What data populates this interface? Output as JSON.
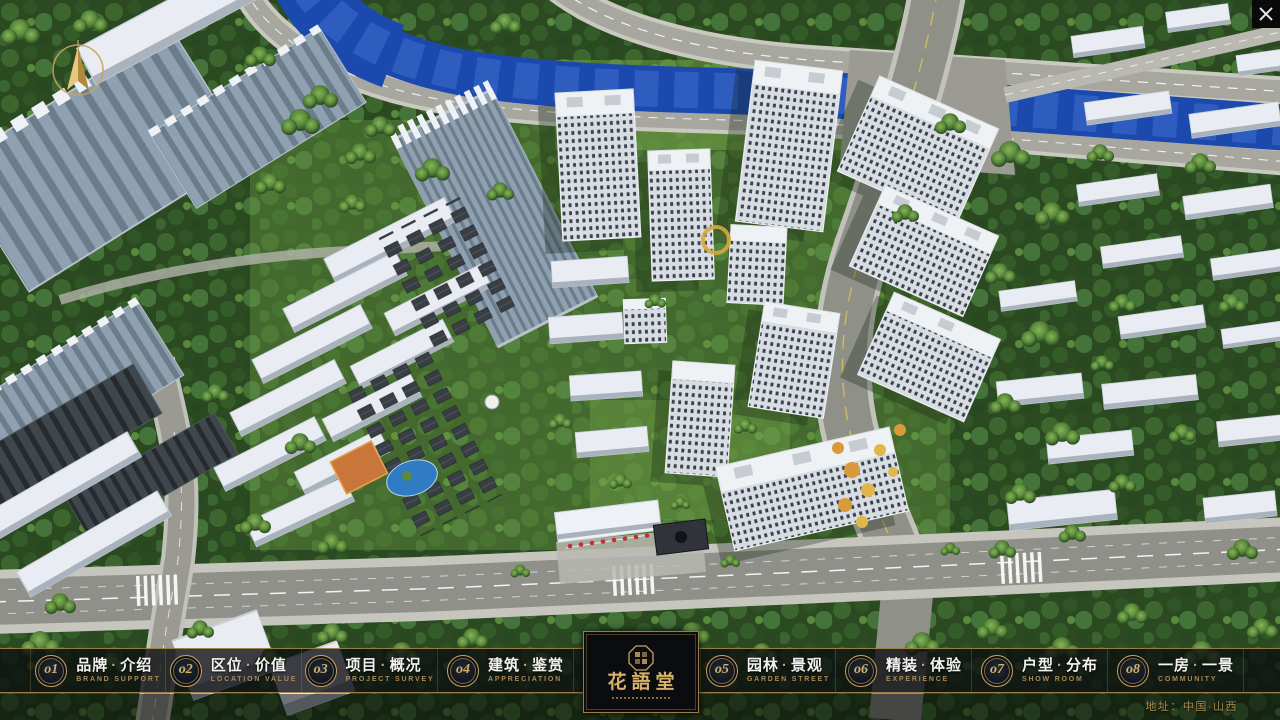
{
  "nav": {
    "separator": "·",
    "items": [
      {
        "number": "o1",
        "zh_left": "品牌",
        "zh_right": "介绍",
        "en": "BRAND SUPPORT"
      },
      {
        "number": "o2",
        "zh_left": "区位",
        "zh_right": "价值",
        "en": "LOCATION VALUE"
      },
      {
        "number": "o3",
        "zh_left": "项目",
        "zh_right": "概况",
        "en": "PROJECT SURVEY"
      },
      {
        "number": "o4",
        "zh_left": "建筑",
        "zh_right": "鉴赏",
        "en": "APPRECIATION"
      },
      {
        "number": "o5",
        "zh_left": "园林",
        "zh_right": "景观",
        "en": "GARDEN STREET"
      },
      {
        "number": "o6",
        "zh_left": "精装",
        "zh_right": "体验",
        "en": "EXPERIENCE"
      },
      {
        "number": "o7",
        "zh_left": "户型",
        "zh_right": "分布",
        "en": "SHOW ROOM"
      },
      {
        "number": "o8",
        "zh_left": "一房",
        "zh_right": "一景",
        "en": "COMMUNITY"
      }
    ]
  },
  "logo": {
    "title": "花語堂"
  },
  "footer": {
    "address": "地址：中国·山西"
  },
  "window": {
    "close_icon": "✕"
  },
  "colors": {
    "gold": "#C9A25F",
    "gold_dark": "#8A7440",
    "bar_bg": "rgba(10,12,15,0.78)",
    "river_blue": "#1C49AE",
    "asphalt": "#8F9088",
    "tree_dark": "#2B4A21",
    "building_white": "#E9EDF3",
    "city_slab_grey": "#93A3B3"
  }
}
